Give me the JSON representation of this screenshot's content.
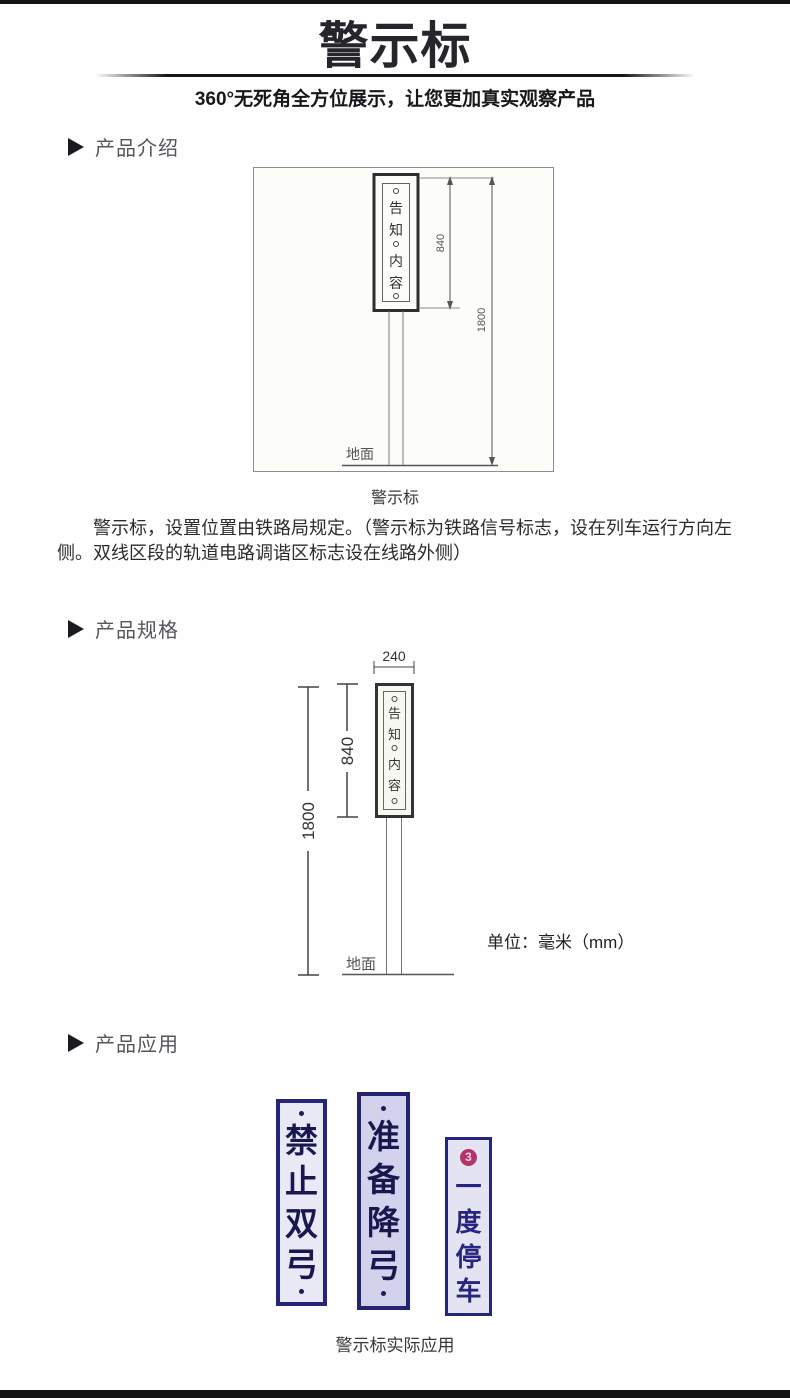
{
  "header": {
    "title": "警示标",
    "subtitle": "360°无死角全方位展示，让您更加真实观察产品"
  },
  "sections": {
    "intro": {
      "heading": "产品介绍",
      "caption": "警示标",
      "paragraph": "警示标，设置位置由铁路局规定。（警示标为铁路信号标志，设在列车运行方向左侧。双线区段的轨道电路调谐区标志设在线路外侧）"
    },
    "specs": {
      "heading": "产品规格",
      "unit_note": "单位：毫米（mm）"
    },
    "application": {
      "heading": "产品应用",
      "caption": "警示标实际应用"
    }
  },
  "diagram_intro": {
    "sign_chars": [
      "告",
      "知",
      "内",
      "容"
    ],
    "dim_sign_height": "840",
    "dim_total_height": "1800",
    "ground_label": "地面"
  },
  "diagram_specs": {
    "sign_chars": [
      "告",
      "知",
      "内",
      "容"
    ],
    "dim_width": "240",
    "dim_sign_height": "840",
    "dim_total_height": "1800",
    "ground_label": "地面"
  },
  "app_signs": [
    {
      "name": "禁止双弓",
      "chars": [
        "禁",
        "止",
        "双",
        "弓"
      ]
    },
    {
      "name": "准备降弓",
      "chars": [
        "准",
        "备",
        "降",
        "弓"
      ]
    },
    {
      "name": "一度停车",
      "chars": [
        "一",
        "度",
        "停",
        "车"
      ],
      "badge": "3"
    }
  ],
  "colors": {
    "accent_navy": "#252579",
    "sign_text_navy": "#18184f",
    "badge_red": "#b23468",
    "bar_black": "#141414"
  }
}
